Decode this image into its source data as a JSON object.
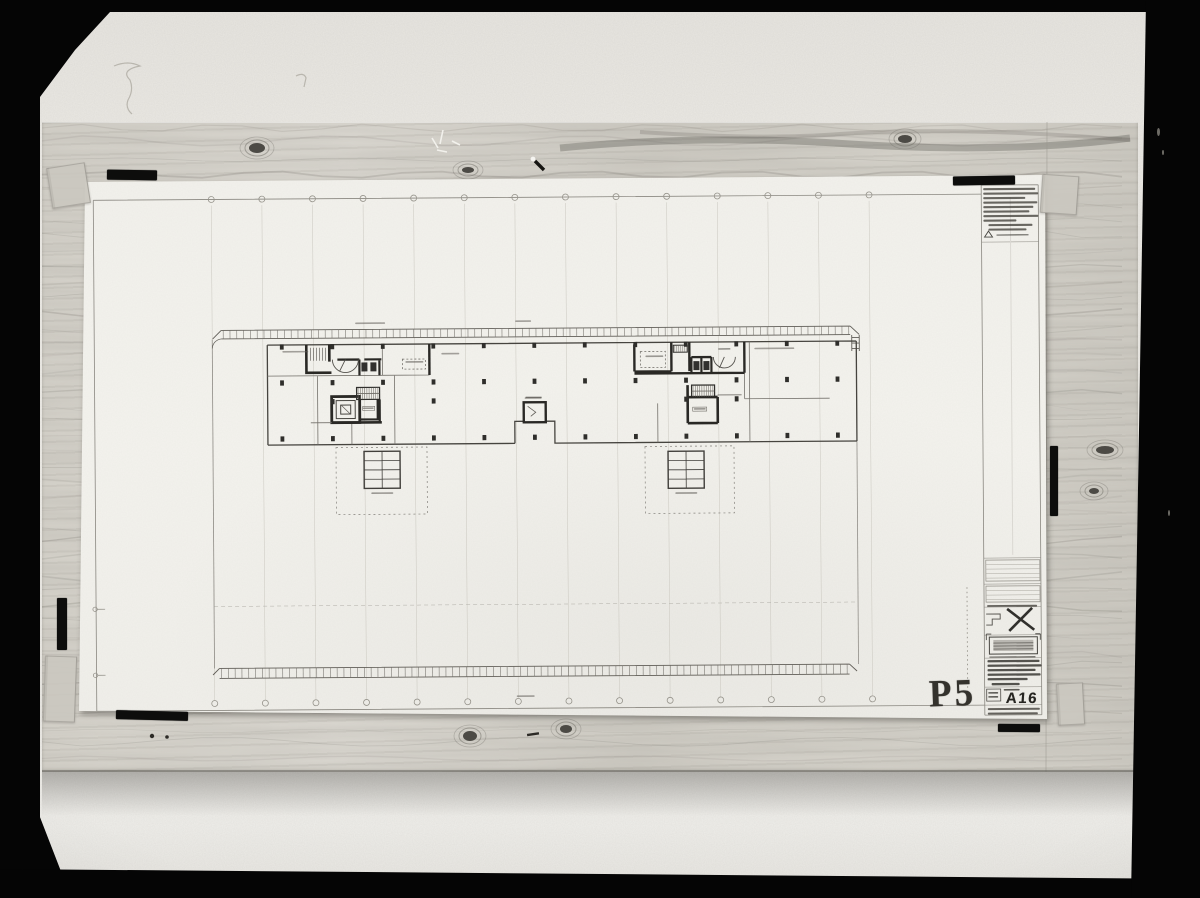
{
  "stamps": {
    "plate": "P5",
    "sheet": "A16"
  },
  "colors": {
    "film_border": "#050505",
    "wall": "#eceae5",
    "wood": "#d5d2ca",
    "paper": "#f3f2ed",
    "ink_dark": "#1b1a17",
    "ink_mid": "#55524c",
    "grid_faint": "#c7c4bc"
  },
  "drawing": {
    "grid_axis_circles_top": 14,
    "grid_axis_circles_bottom": 14,
    "roof_light_squares": 2,
    "title_block_text": "illegible",
    "margin_notes_text": "illegible",
    "room_labels": "illegible"
  }
}
